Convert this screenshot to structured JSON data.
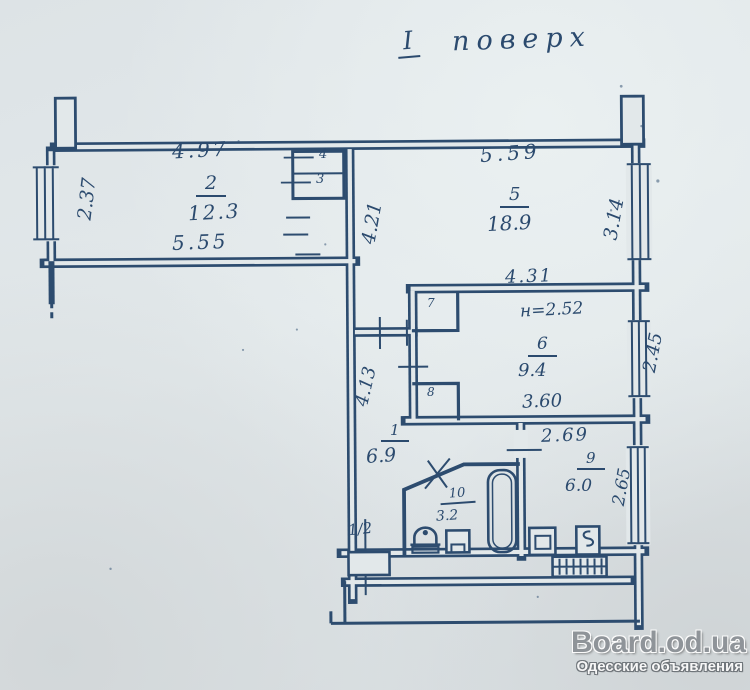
{
  "page": {
    "floor_title": {
      "roman": "I",
      "word": "поверх"
    }
  },
  "rooms": {
    "r1": {
      "num": "1",
      "area": "6.9",
      "dim_left": "4.13"
    },
    "r2": {
      "num": "2",
      "area": "12.3",
      "dim_top": "4.97",
      "dim_bottom": "5.55",
      "dim_left": "2.37"
    },
    "r3": {
      "num": "3"
    },
    "r4": {
      "num": "4"
    },
    "r5": {
      "num": "5",
      "area": "18.9",
      "dim_top": "5.59",
      "dim_left": "4.21",
      "dim_right": "3.14"
    },
    "r6": {
      "num": "6",
      "area": "9.4",
      "dim_top": "4.31",
      "height_note": "н=2.52",
      "dim_bottom": "3.60",
      "dim_right": "2.45"
    },
    "r7": {
      "num": "7"
    },
    "r8": {
      "num": "8"
    },
    "r9": {
      "num": "9",
      "area": "6.0",
      "dim_top": "2.69",
      "dim_right": "2.65"
    },
    "r10": {
      "num": "10",
      "area": "3.2"
    },
    "stair_half": {
      "label": "1/2"
    }
  },
  "watermark": {
    "site": "Board.od.ua",
    "tagline": "Одесские объявления"
  },
  "colors": {
    "ink": "#2d4c6f",
    "paper": "#e2e8ea",
    "watermark_gray": "#8f9499"
  },
  "icons": {
    "fixtures": [
      "toilet-icon",
      "washbasin-icon",
      "bathtub-icon",
      "kitchen-sink-icon",
      "stove-icon",
      "radiator-grate-icon",
      "window-icon"
    ]
  }
}
